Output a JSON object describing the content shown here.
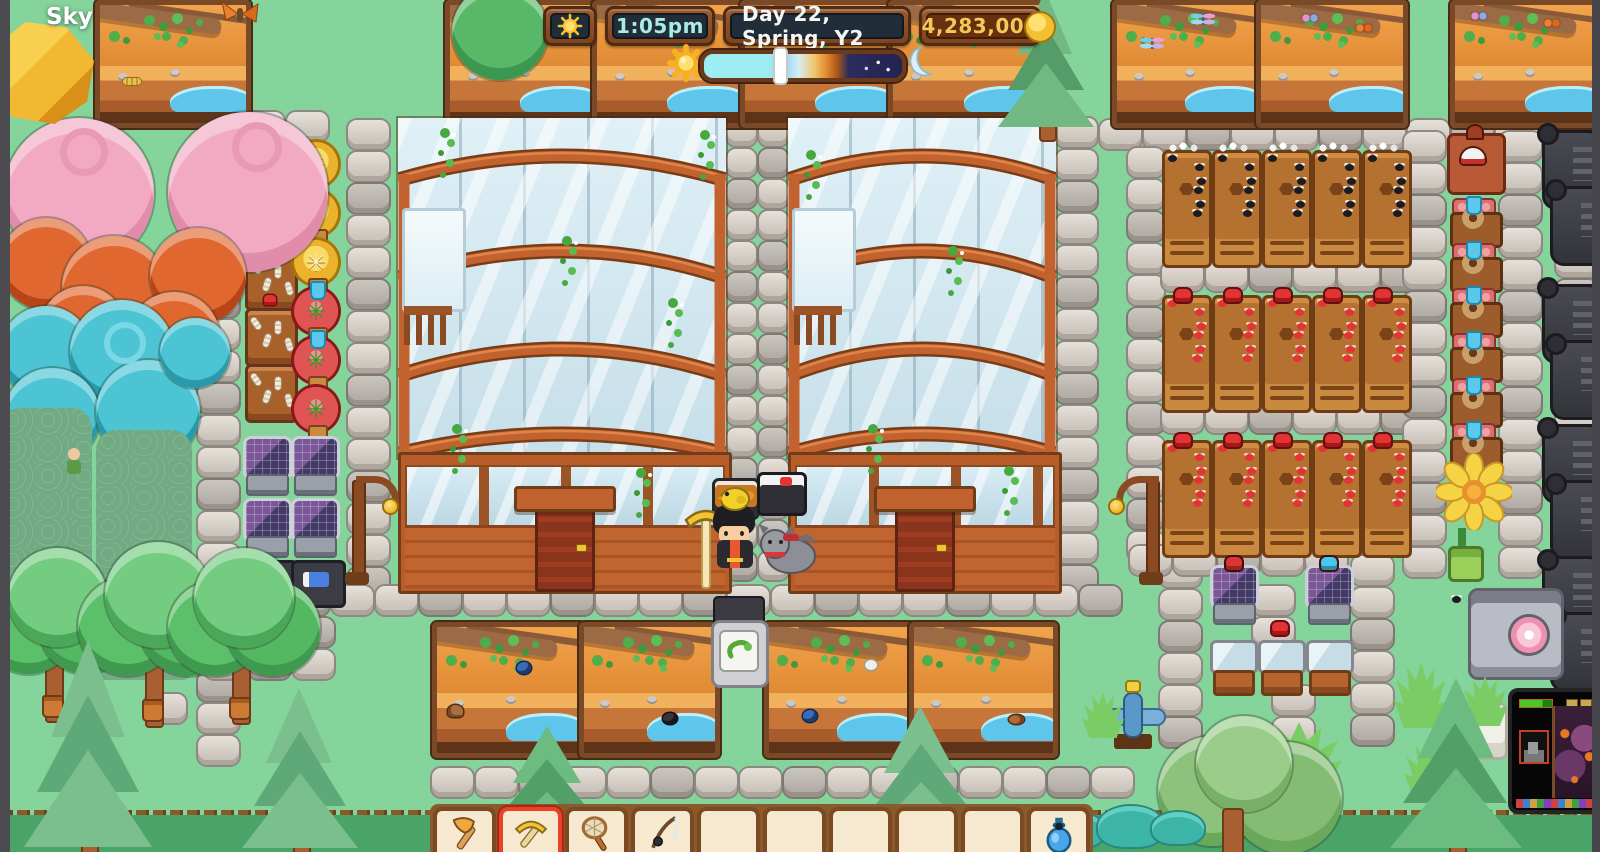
{
  "window": {
    "label": "Sky"
  },
  "hud": {
    "weather_icon": "sun-icon",
    "time": "1:05pm",
    "date": "Day 22, Spring, Y2",
    "money": "4,283,009",
    "currency_icon": "gold-coin-icon",
    "day_progress": {
      "percent": 38,
      "start_icon": "sun-icon",
      "end_icon": "moon-icon"
    }
  },
  "hotbar": {
    "selected_index": 1,
    "slots": [
      {
        "item": "axe"
      },
      {
        "item": "pickaxe"
      },
      {
        "item": "bug-net"
      },
      {
        "item": "fishing-rod"
      },
      {
        "item": ""
      },
      {
        "item": ""
      },
      {
        "item": ""
      },
      {
        "item": ""
      },
      {
        "item": ""
      },
      {
        "item": "blue-bottle"
      }
    ]
  },
  "pip_window": {
    "label": "secondary-game-window"
  },
  "colors": {
    "grass": "#5bbb7f",
    "hud_time_text": "#a9ece0",
    "hud_date_text": "#f2f7f5",
    "hud_money_text": "#f6c75a",
    "selected_slot_border": "#e8432a",
    "day_track_gradient": [
      "#9ceef2",
      "#8fd8f0",
      "#f0c468",
      "#b05818",
      "#232350"
    ]
  }
}
